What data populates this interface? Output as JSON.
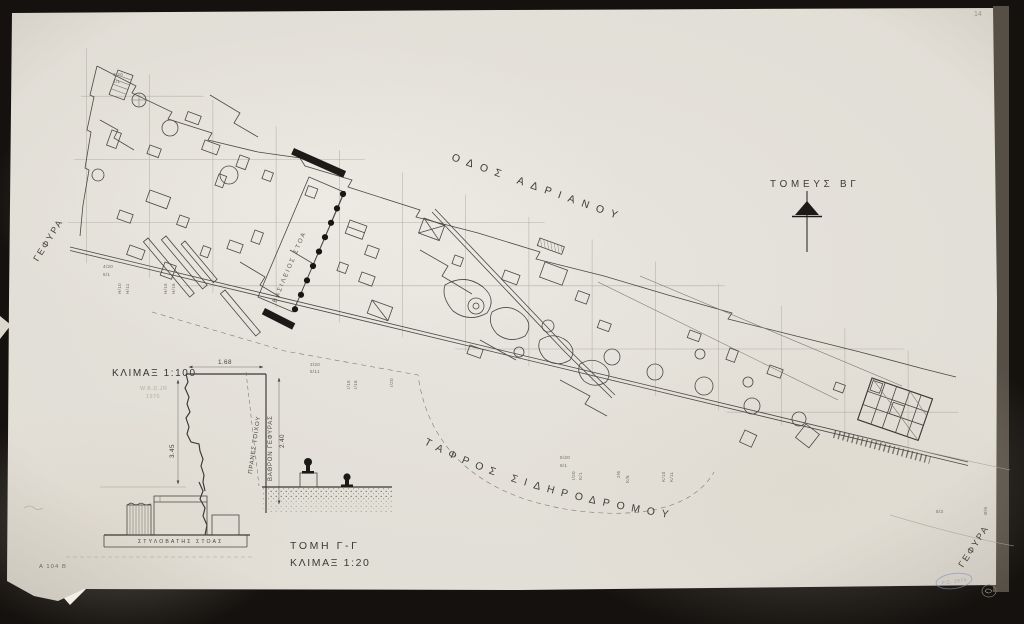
{
  "colors": {
    "paper": "#e9e6df",
    "scan_background": "#14110e",
    "ink": "#3f3e3a",
    "stamp_blue": "#8290bf"
  },
  "plan": {
    "street_label": "ΟΔΟΣ ΑΔΡΙΑΝΟΥ",
    "sector_label": "ΤΟΜΕΥΣ ΒΓ",
    "railway_trench_label": "ΤΑΦΡΟΣ ΣΙΔΗΡΟΔΡΟΜΟΥ",
    "bridge_label_left": "ΓΕΦΥΡΑ",
    "bridge_label_right": "ΓΕΦΥΡΑ",
    "stoa_label": "ΒΑΣΙΛΕΙΟΣ ΣΤΟΑ",
    "north_marker": "north-arrow"
  },
  "profile_1_100": {
    "scale_label": "ΚΛΙΜΑΞ 1:100",
    "credit_name": "W.B.D.JR",
    "credit_year": "1970",
    "dim_top": "1.68",
    "dim_right": "2.40",
    "dim_left": "3.45",
    "wall_slope_label": "ΠΡΑΝΕΣ ΤΟΙΧΟΥ",
    "bridge_pier_label": "ΒΑΘΡΟΝ ΓΕΦΥΡΑΣ"
  },
  "section_1_20": {
    "title": "ΤΟΜΗ Γ-Γ",
    "scale_label": "ΚΛΙΜΑΞ 1:20",
    "stylobate_label": "ΣΤΥΛΟΒΑΤΗΣ ΣΤΟΑΣ"
  },
  "annotations": {
    "drawing_number": "Α 104 Β",
    "pencil_page_mark": "14",
    "stamp_text": "P.D. 1974"
  },
  "grid_labels": [
    {
      "t": "3/20",
      "x": 113,
      "y": 76,
      "r": 0
    },
    {
      "t": "4/1",
      "x": 113,
      "y": 83,
      "r": 0
    },
    {
      "t": "4/20",
      "x": 103,
      "y": 268,
      "r": 0
    },
    {
      "t": "5/1",
      "x": 103,
      "y": 276,
      "r": 0
    },
    {
      "t": "Η/10",
      "x": 121,
      "y": 294,
      "r": -90
    },
    {
      "t": "Η/11",
      "x": 129,
      "y": 294,
      "r": -90
    },
    {
      "t": "Η/15",
      "x": 167,
      "y": 294,
      "r": -90
    },
    {
      "t": "Η/16",
      "x": 175,
      "y": 294,
      "r": -90
    },
    {
      "t": "3/20",
      "x": 310,
      "y": 366,
      "r": 0
    },
    {
      "t": "5/11",
      "x": 310,
      "y": 373,
      "r": 0
    },
    {
      "t": "Ι/15",
      "x": 350,
      "y": 389,
      "r": -90
    },
    {
      "t": "Ι/16",
      "x": 357,
      "y": 389,
      "r": -90
    },
    {
      "t": "Ι/20",
      "x": 393,
      "y": 387,
      "r": -90
    },
    {
      "t": "5/20",
      "x": 560,
      "y": 459,
      "r": 0
    },
    {
      "t": "6/1",
      "x": 560,
      "y": 467,
      "r": 0
    },
    {
      "t": "Ι/20",
      "x": 575,
      "y": 480,
      "r": -90
    },
    {
      "t": "Κ/1",
      "x": 582,
      "y": 480,
      "r": -90
    },
    {
      "t": "2/6",
      "x": 620,
      "y": 478,
      "r": -90
    },
    {
      "t": "Κ/6",
      "x": 629,
      "y": 483,
      "r": -90
    },
    {
      "t": "Κ/10",
      "x": 665,
      "y": 482,
      "r": -90
    },
    {
      "t": "Κ/11",
      "x": 673,
      "y": 482,
      "r": -90
    },
    {
      "t": "5/3",
      "x": 936,
      "y": 513,
      "r": 0
    },
    {
      "t": "Θ/5",
      "x": 987,
      "y": 515,
      "r": -90
    }
  ]
}
